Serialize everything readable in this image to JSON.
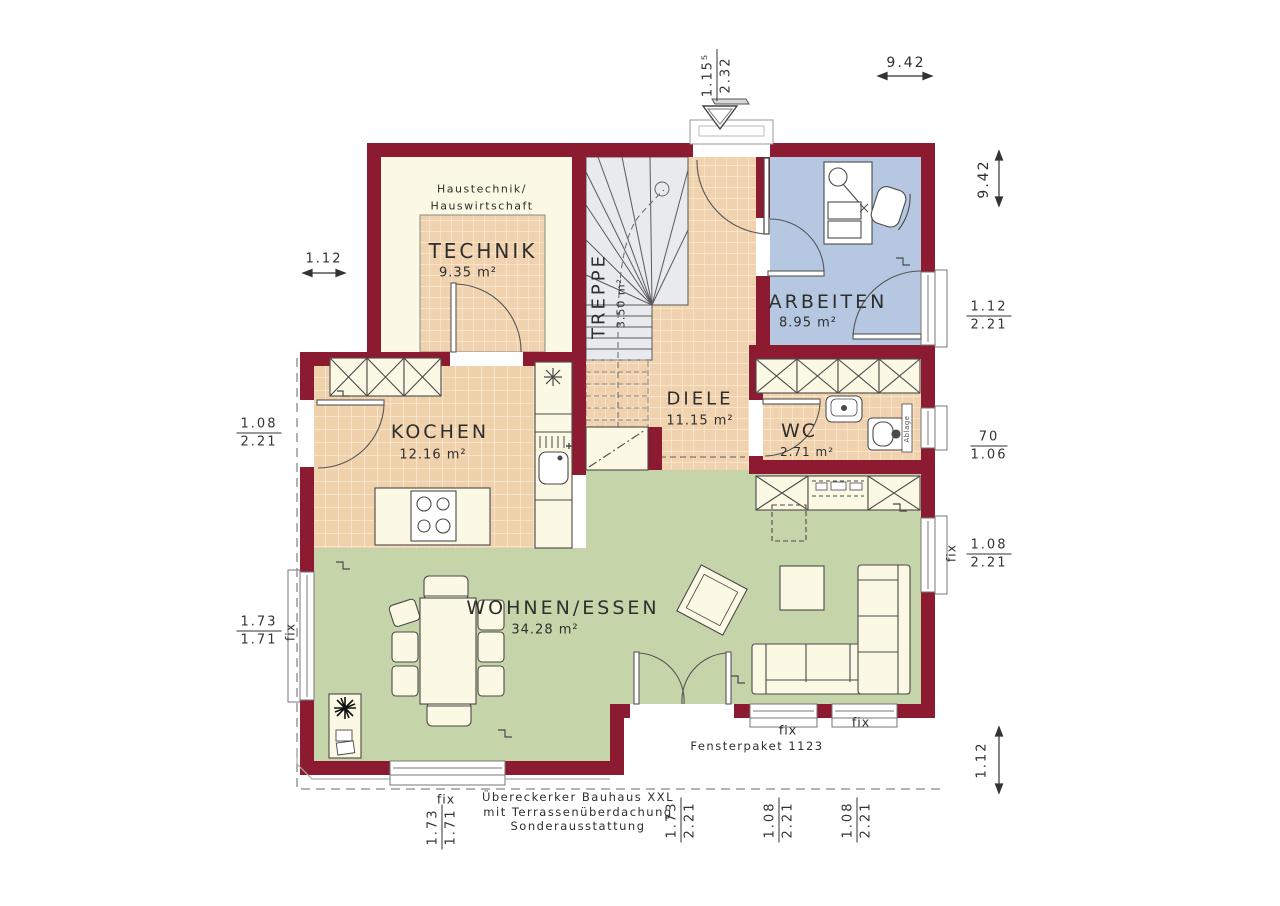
{
  "title": "floor-plan",
  "colors": {
    "wall": "#8C1A30",
    "cream": "#FBF8E3",
    "tile": "#F0D3AE",
    "tile_line": "#FAE9D2",
    "stair_gray": "#E9EAEE",
    "arbeiten_blue": "#B6C8E1",
    "wohnen_green": "#C6D5A9"
  },
  "rooms": {
    "technik": {
      "name": "TECHNIK",
      "area": "9.35 m²",
      "note1": "Haustechnik/",
      "note2": "Hauswirtschaft"
    },
    "treppe": {
      "name": "TREPPE",
      "area": "3.50 m²"
    },
    "diele": {
      "name": "DIELE",
      "area": "11.15 m²"
    },
    "arbeiten": {
      "name": "ARBEITEN",
      "area": "8.95 m²"
    },
    "kochen": {
      "name": "KOCHEN",
      "area": "12.16 m²"
    },
    "wc": {
      "name": "WC",
      "area": "2.71 m²",
      "shelf": "Ablage"
    },
    "wohnen": {
      "name": "WOHNEN/ESSEN",
      "area": "34.28 m²"
    }
  },
  "dims": {
    "top_door": {
      "num": "1.15⁵",
      "den": "2.32"
    },
    "top_width": "9.42",
    "right_height": "9.42",
    "right_arbeiten": {
      "num": "1.12",
      "den": "2.21"
    },
    "right_wc": {
      "num": "70",
      "den": "1.06"
    },
    "right_wohnen": {
      "num": "1.08",
      "den": "2.21"
    },
    "right_overhang": "1.12",
    "left_notch": "1.12",
    "left_kochen": {
      "num": "1.08",
      "den": "2.21"
    },
    "left_wohnen": {
      "num": "1.73",
      "den": "1.71"
    },
    "bottom_bay": {
      "num": "1.73",
      "den": "1.71"
    },
    "bottom_terrace": {
      "num": "1.73",
      "den": "2.21"
    },
    "bottom_win1": {
      "num": "1.08",
      "den": "2.21"
    },
    "bottom_win2": {
      "num": "1.08",
      "den": "2.21"
    }
  },
  "labels": {
    "fix": "fix",
    "fensterpaket": "Fensterpaket 1123",
    "footer1": "Übereckerker Bauhaus XXL",
    "footer2": "mit Terrassenüberdachung",
    "footer3": "Sonderausstattung"
  }
}
